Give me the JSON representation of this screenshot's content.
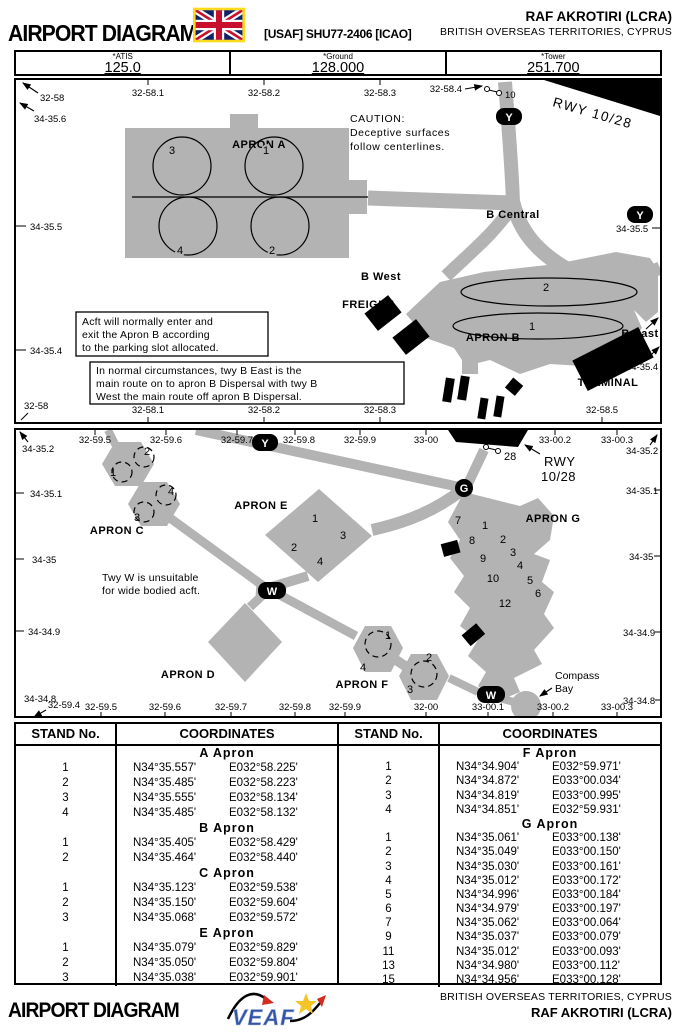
{
  "header": {
    "title": "AIRPORT DIAGRAM",
    "procedure_id": "[USAF] SHU77-2406 [ICAO]",
    "airport": "RAF AKROTIRI (LCRA)",
    "territory": "BRITISH OVERSEAS TERRITORIES, CYPRUS",
    "flag": "uk-flag"
  },
  "frequencies": [
    {
      "label": "*ATIS",
      "value": "125.0"
    },
    {
      "label": "*Ground",
      "value": "128.000"
    },
    {
      "label": "*Tower",
      "value": "251.700"
    }
  ],
  "map1": {
    "runway_label": "RWY 10/28",
    "threshold_label": "10",
    "caution": [
      "CAUTION:",
      "Deceptive surfaces",
      "follow centerlines."
    ],
    "apron_a": "APRON A",
    "apron_a_stands": [
      "3",
      "1",
      "4",
      "2"
    ],
    "apron_b": "APRON B",
    "apron_b_stands": [
      "2",
      "1"
    ],
    "b_central": "B Central",
    "b_west": "B West",
    "b_east": "B East",
    "freight": "FREIGHT",
    "terminal": "TERMINAL",
    "twy_y": "Y",
    "note1": [
      "Acft will normally enter and",
      "exit the Apron B according",
      "to the parking slot allocated."
    ],
    "note2": [
      "In normal circumstances, twy B East is the",
      "main route on to apron B Dispersal with twy B",
      "West the main route off apron B Dispersal."
    ],
    "corner_lon": "32-58",
    "corner_lat": "34-35.6",
    "left_labels": [
      "34-35.5",
      "34-35.4"
    ],
    "bottom_left": "32-58",
    "right_labels": [
      "34-35.5",
      "34-35.4"
    ],
    "top_ticks": [
      "32-58.1",
      "32-58.2",
      "32-58.3",
      "32-58.4"
    ],
    "bottom_ticks": [
      "32-58.1",
      "32-58.2",
      "32-58.3",
      "32-58.5"
    ]
  },
  "map2": {
    "runway_line1": "RWY",
    "runway_line2": "10/28",
    "threshold_label": "28",
    "apron_c": "APRON C",
    "apron_d": "APRON D",
    "apron_e": "APRON E",
    "apron_f": "APRON F",
    "apron_g": "APRON G",
    "apron_c_stands": [
      "1",
      "2",
      "3",
      "4"
    ],
    "apron_e_stands": [
      "1",
      "2",
      "3",
      "4"
    ],
    "apron_f_stands": [
      "1",
      "4",
      "2",
      "3"
    ],
    "apron_g_stands": [
      "7",
      "1",
      "8",
      "2",
      "9",
      "3",
      "4",
      "10",
      "5",
      "12",
      "6"
    ],
    "note": [
      "Twy W is unsuitable",
      "for wide bodied acft."
    ],
    "compass_bay": [
      "Compass",
      "Bay"
    ],
    "twy_y": "Y",
    "twy_g": "G",
    "twy_w": "W",
    "top_ticks": [
      "32-59.5",
      "32-59.6",
      "32-59.7",
      "32-59.8",
      "32-59.9",
      "33-00",
      "33-00.2",
      "33-00.3"
    ],
    "bottom_ticks": [
      "32-59.4",
      "32-59.5",
      "32-59.6",
      "32-59.7",
      "32-59.8",
      "32-59.9",
      "32-00",
      "33-00.1",
      "33-00.2",
      "33-00.3"
    ],
    "left_labels": [
      "34-35.2",
      "34-35.1",
      "34-35",
      "34-34.9",
      "34-34.8"
    ],
    "right_labels": [
      "34-35.2",
      "34-35.1",
      "34-35",
      "34-34.9",
      "34-34.8"
    ]
  },
  "tables": {
    "header_stand": "STAND No.",
    "header_coords": "COORDINATES",
    "left": [
      {
        "apron": "A Apron",
        "rows": [
          [
            "1",
            "N34°35.557'",
            "E032°58.225'"
          ],
          [
            "2",
            "N34°35.485'",
            "E032°58.223'"
          ],
          [
            "3",
            "N34°35.555'",
            "E032°58.134'"
          ],
          [
            "4",
            "N34°35.485'",
            "E032°58.132'"
          ]
        ]
      },
      {
        "apron": "B Apron",
        "rows": [
          [
            "1",
            "N34°35.405'",
            "E032°58.429'"
          ],
          [
            "2",
            "N34°35.464'",
            "E032°58.440'"
          ]
        ]
      },
      {
        "apron": "C Apron",
        "rows": [
          [
            "1",
            "N34°35.123'",
            "E032°59.538'"
          ],
          [
            "2",
            "N34°35.150'",
            "E032°59.604'"
          ],
          [
            "3",
            "N34°35.068'",
            "E032°59.572'"
          ]
        ]
      },
      {
        "apron": "E Apron",
        "rows": [
          [
            "1",
            "N34°35.079'",
            "E032°59.829'"
          ],
          [
            "2",
            "N34°35.050'",
            "E032°59.804'"
          ],
          [
            "3",
            "N34°35.038'",
            "E032°59.901'"
          ]
        ]
      }
    ],
    "right": [
      {
        "apron": "F Apron",
        "rows": [
          [
            "1",
            "N34°34.904'",
            "E032°59.971'"
          ],
          [
            "2",
            "N34°34.872'",
            "E033°00.034'"
          ],
          [
            "3",
            "N34°34.819'",
            "E033°00.995'"
          ],
          [
            "4",
            "N34°34.851'",
            "E032°59.931'"
          ]
        ]
      },
      {
        "apron": "G Apron",
        "rows": [
          [
            "1",
            "N34°35.061'",
            "E033°00.138'"
          ],
          [
            "2",
            "N34°35.049'",
            "E033°00.150'"
          ],
          [
            "3",
            "N34°35.030'",
            "E033°00.161'"
          ],
          [
            "4",
            "N34°35.012'",
            "E033°00.172'"
          ],
          [
            "5",
            "N34°34.996'",
            "E033°00.184'"
          ],
          [
            "6",
            "N34°34.979'",
            "E033°00.197'"
          ],
          [
            "7",
            "N34°35.062'",
            "E033°00.064'"
          ],
          [
            "9",
            "N34°35.037'",
            "E033°00.079'"
          ],
          [
            "11",
            "N34°35.012'",
            "E033°00.093'"
          ],
          [
            "13",
            "N34°34.980'",
            "E033°00.112'"
          ],
          [
            "15",
            "N34°34.956'",
            "E033°00.128'"
          ]
        ]
      }
    ]
  },
  "footer": {
    "title": "AIRPORT DIAGRAM",
    "territory": "BRITISH OVERSEAS TERRITORIES, CYPRUS",
    "airport": "RAF AKROTIRI (LCRA)",
    "logo": "VEAF"
  }
}
